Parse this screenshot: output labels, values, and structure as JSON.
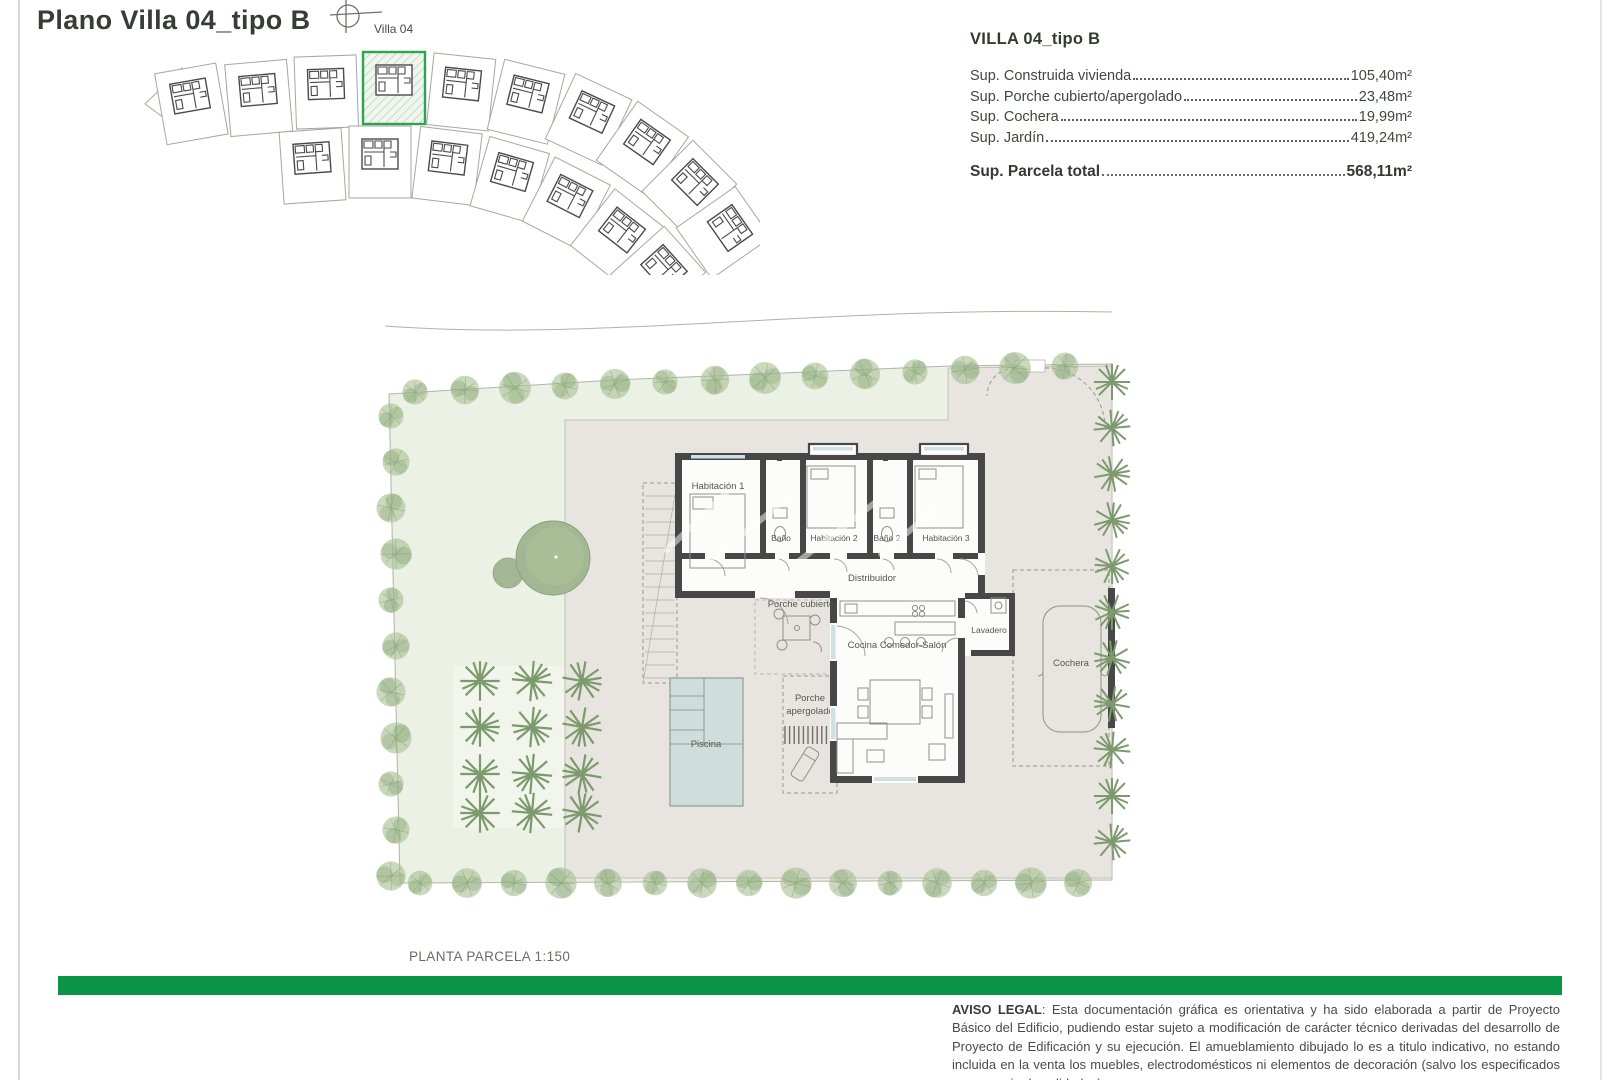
{
  "title": "Plano Villa 04_tipo B",
  "site_plan": {
    "villa_label": "Villa 04"
  },
  "spec": {
    "title": "VILLA 04_tipo B",
    "rows": [
      {
        "label": "Sup. Construida vivienda",
        "value": "105,40m²"
      },
      {
        "label": "Sup. Porche cubierto/apergolado",
        "value": "23,48m²"
      },
      {
        "label": "Sup. Cochera",
        "value": "19,99m²"
      },
      {
        "label": "Sup. Jardín",
        "value": "419,24m²"
      }
    ],
    "total_label": "Sup. Parcela total",
    "total_value": "568,11m²"
  },
  "plan": {
    "rooms": {
      "habitacion1": "Habitación 1",
      "bano1": "Baño",
      "habitacion2": "Habitación 2",
      "bano2": "Baño 2",
      "habitacion3": "Habitación 3",
      "distribuidor": "Distribuidor",
      "porche_cubierto": "Porche cubierto",
      "porche_line1": "Porche",
      "porche_line2": "apergolado",
      "cocina": "Cocina Comedor-Salón",
      "lavadero": "Lavadero",
      "cochera": "Cochera",
      "piscina": "Piscina"
    },
    "caption": "PLANTA PARCELA 1:150"
  },
  "legal": {
    "heading": "AVISO LEGAL",
    "body": ": Esta documentación gráfica es orientativa y ha sido elaborada a partir de Proyecto Básico del Edificio, pudiendo estar sujeto a modificación de carácter técnico derivadas del desarrollo de Proyecto de Edificación y su ejecución. El amueblamiento dibujado lo es a titulo indicativo, no estando incluida en la venta los muebles, electrodomésticos ni elementos de decoración (salvo los especificados en memoria de calidades)"
  },
  "colors": {
    "accent_green": "#0a9546",
    "highlight_green": "#2ea44f",
    "wall": "#474747",
    "lawn": "#ecf1e5",
    "terrace": "#e8e5e0",
    "pool": "#cfdeda"
  }
}
